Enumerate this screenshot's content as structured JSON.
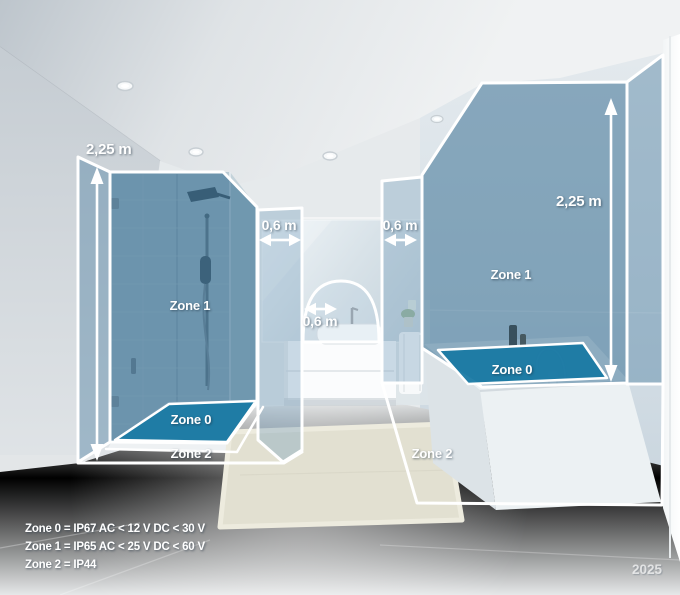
{
  "measurements": {
    "shower_height": "2,25 m",
    "shower_strip_width": "0,6 m",
    "basin_arc_radius": "0,6 m",
    "bath_strip_width": "0,6 m",
    "bath_height": "2,25 m"
  },
  "zones": {
    "shower_zone1": "Zone 1",
    "shower_zone0": "Zone 0",
    "shower_zone2": "Zone 2",
    "bath_zone1": "Zone 1",
    "bath_zone0": "Zone 0",
    "bath_zone2": "Zone 2"
  },
  "legend": {
    "line1": "Zone 0 = IP67 AC < 12 V DC < 30 V",
    "line2": "Zone 1 = IP65 AC < 25 V DC < 60 V",
    "line3": "Zone 2 = IP44"
  },
  "year": "2025",
  "colors": {
    "zone_overlay": "#3a7092",
    "zone0_fill": "#1a7aa4",
    "outline": "#ffffff"
  }
}
